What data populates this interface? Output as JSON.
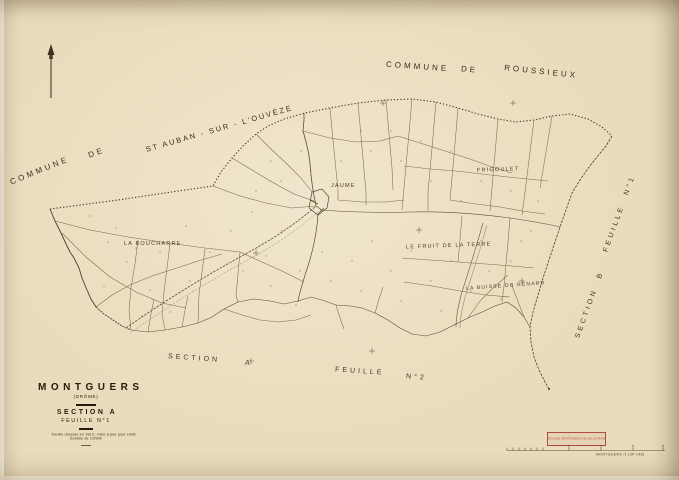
{
  "colors": {
    "paper": "#e9dcbd",
    "ink": "#5f4d36",
    "title_ink": "#241b0e",
    "stamp_red": "#b24a3e"
  },
  "neighbors": {
    "top": {
      "w1": "COMMUNE",
      "w2": "DE",
      "w3": "ROUSSIEUX"
    },
    "left": {
      "w1": "COMMUNE",
      "w2": "DE",
      "w3": "ST AUBAN - SUR - L'OUVÈZE"
    }
  },
  "adjacent": {
    "right": {
      "section_word": "SECTION",
      "section_letter": "B",
      "feuille_word": "FEUILLE",
      "feuille_no": "N°1"
    },
    "bottom": {
      "section_word": "SECTION",
      "section_letter": "A",
      "feuille_word": "FEUILLE",
      "feuille_no": "N°2"
    }
  },
  "places": {
    "jaume": "JAUME",
    "frigoulet": "FRIGOULET",
    "fruit_de_la_terre": "LE FRUIT DE LA TERRE",
    "buisse_du_renard": "LA BUISSE DU RENARD",
    "boucharre": "LA BOUCHARRE"
  },
  "title_block": {
    "commune": "MONTGUERS",
    "departement": "(DRÔME)",
    "section": "SECTION A",
    "feuille": "FEUILLE N°1",
    "note1": "Feuille dressée en 1813 , mise à jour pour 1938",
    "note2": "Échelle de 1/2500"
  },
  "stamp": {
    "text": "ARCHIVES DÉPARTEMENTALES DE LA DRÔME"
  },
  "footer": {
    "reference": "MONTGUERS /1 (3P 148)"
  }
}
